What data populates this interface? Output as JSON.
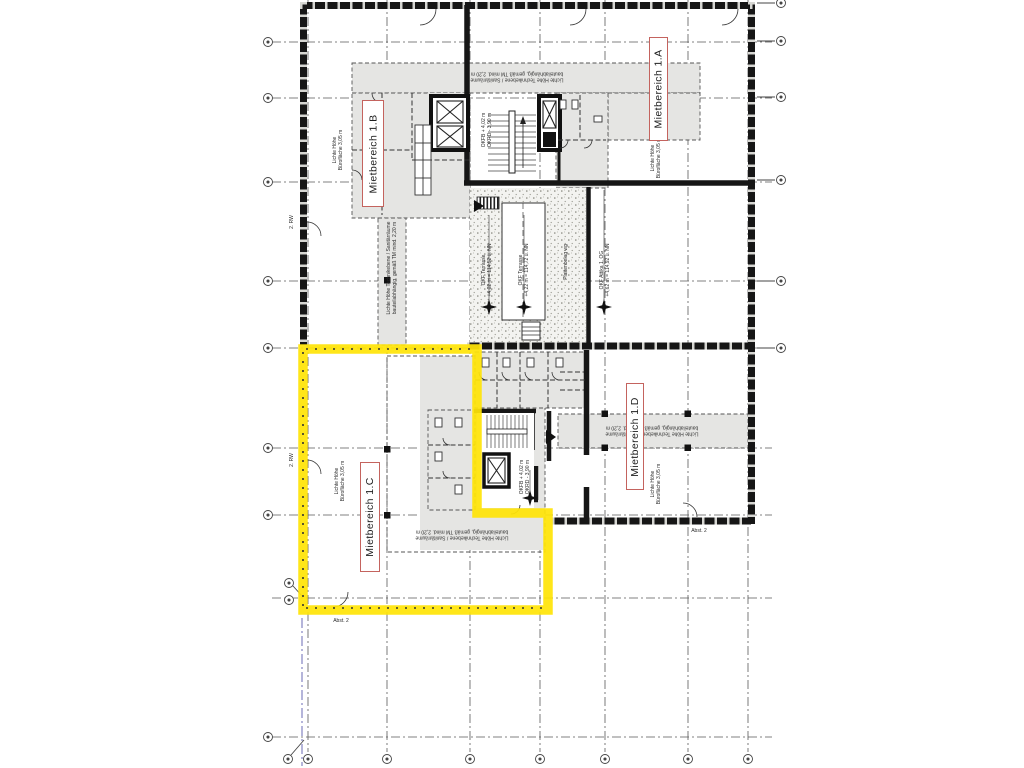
{
  "drawing": {
    "type": "floor-plan",
    "highlight_color": "#ffe408",
    "label_border_color": "#c4635e",
    "zone_fill_color": "#e5e5e3",
    "wall_color": "#161616",
    "grid_color": "#5a5a5a"
  },
  "rental_areas": [
    {
      "id": "1A",
      "label": "Mietbereich 1.A",
      "highlighted": false
    },
    {
      "id": "1B",
      "label": "Mietbereich 1.B",
      "highlighted": false
    },
    {
      "id": "1C",
      "label": "Mietbereich 1.C",
      "highlighted": true
    },
    {
      "id": "1D",
      "label": "Mietbereich 1.D",
      "highlighted": false
    }
  ],
  "annotations": {
    "clear_height_office": "Lichte Höhe\nBürofläche 3,05 m",
    "clear_height_tech": "Lichte Höhe Technikebene / Sanitärräume\nbauteilabhängig, gemäß TM mind. 2,20 m",
    "okf_terrasse_low": "OKF Terrasse\n+4,02 m = 114,52 ü. NN",
    "okf_terrasse_high": "OKF Terrasse\n+4,22 m = 114,72 ü. NN",
    "okf_attika": "OKF Attika 1. OG\n+4,62 m = 114,92 ü. NN",
    "plattenbelag": "Plattenbelag wg",
    "okfb_levels": "OKFB + 4,02 m\nOKRD - 3,90 m",
    "rescue_route": "2. RW",
    "abstand": "Abst. 2"
  }
}
